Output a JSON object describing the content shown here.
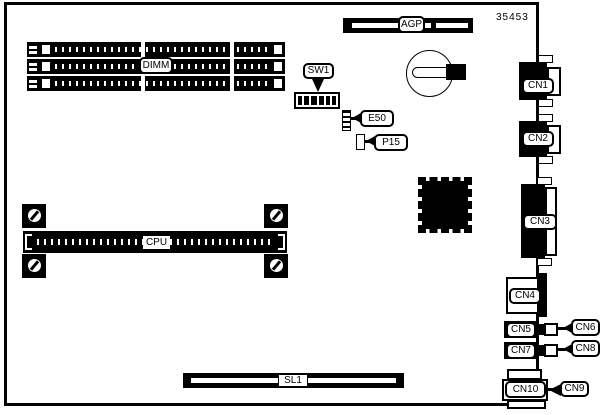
{
  "diagram": {
    "title": "motherboard-layout-diagram",
    "part_number": "35453",
    "colors": {
      "line": "#000000",
      "background": "#ffffff"
    }
  },
  "components": {
    "dimm": {
      "label": "DIMM",
      "slot_count": 3
    },
    "agp": {
      "label": "AGP"
    },
    "sw1": {
      "label": "SW1",
      "segment_count": 6
    },
    "e50": {
      "label": "E50"
    },
    "p15": {
      "label": "P15"
    },
    "cpu": {
      "label": "CPU"
    },
    "sl1": {
      "label": "SL1"
    },
    "cn1": {
      "label": "CN1"
    },
    "cn2": {
      "label": "CN2"
    },
    "cn3": {
      "label": "CN3"
    },
    "cn4": {
      "label": "CN4"
    },
    "cn5": {
      "label": "CN5"
    },
    "cn6": {
      "label": "CN6"
    },
    "cn7": {
      "label": "CN7"
    },
    "cn8": {
      "label": "CN8"
    },
    "cn9": {
      "label": "CN9"
    },
    "cn10": {
      "label": "CN10"
    }
  }
}
